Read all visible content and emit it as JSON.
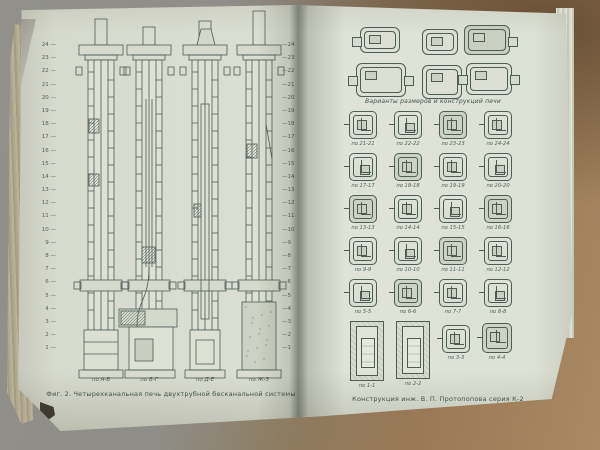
{
  "photo": {
    "subject": "open technical book with stove construction drawings",
    "colors": {
      "ink": "#4d5c55",
      "page": "#dde1d5",
      "page_edges": "#b0a88f",
      "background_gray": "#908f8a",
      "background_wood": "#9a7956"
    }
  },
  "book": {
    "left_page": {
      "margin_numbers": [
        "24",
        "23",
        "22",
        "21",
        "20",
        "19",
        "18",
        "17",
        "16",
        "15",
        "14",
        "13",
        "12",
        "11",
        "10",
        "9",
        "8",
        "7",
        "6",
        "5",
        "4",
        "3",
        "2",
        "1"
      ],
      "figure_labels": [
        "по А-Б",
        "по В-Г",
        "по Д-Е",
        "по Ж-З"
      ],
      "caption": "Фиг. 2. Четырехканальная печь двухтрубной бесканальной системы"
    },
    "right_page": {
      "top_caption": "Варианты размеров и конструкций печи",
      "grid_labels": [
        [
          "по 21-21",
          "по 22-22",
          "по 23-23",
          "по 24-24"
        ],
        [
          "по 17-17",
          "по 18-18",
          "по 19-19",
          "по 20-20"
        ],
        [
          "по 13-13",
          "по 14-14",
          "по 15-15",
          "по 16-16"
        ],
        [
          "по 9-9",
          "по 10-10",
          "по 11-11",
          "по 12-12"
        ],
        [
          "по 5-5",
          "по 6-6",
          "по 7-7",
          "по 8-8"
        ]
      ],
      "bottom_labels": [
        "по 1-1",
        "по 2-2",
        "по 3-3",
        "по 4-4"
      ],
      "caption": "Конструкция инж. В. П. Протопопова серия К-2"
    }
  }
}
